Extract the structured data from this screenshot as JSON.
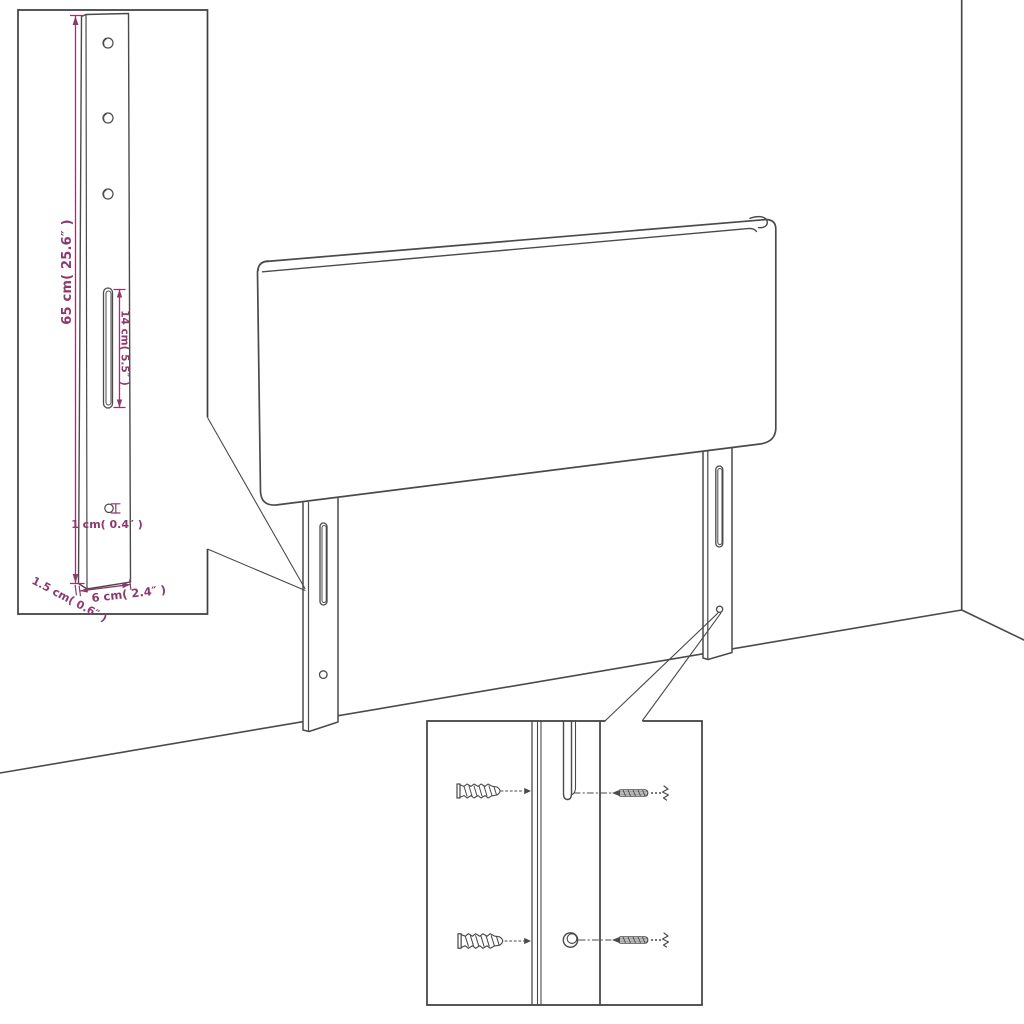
{
  "figure": {
    "kind": "furniture-assembly-diagram",
    "background": "#ffffff",
    "line_color": "#4a4a4a",
    "dimension_color": "#8c396e"
  },
  "bracket_inset": {
    "labels": {
      "height": "65 cm( 25.6″ )",
      "slot_length": "14 cm( 5.5″ )",
      "hole_diameter": "1 cm( 0.4″ )",
      "thickness": "1.5 cm( 0.6″ )",
      "width": "6 cm( 2.4″ )"
    }
  },
  "hardware_inset": {
    "icons": {
      "wall_plug": "wall-plug-icon",
      "screw": "screw-icon"
    }
  }
}
